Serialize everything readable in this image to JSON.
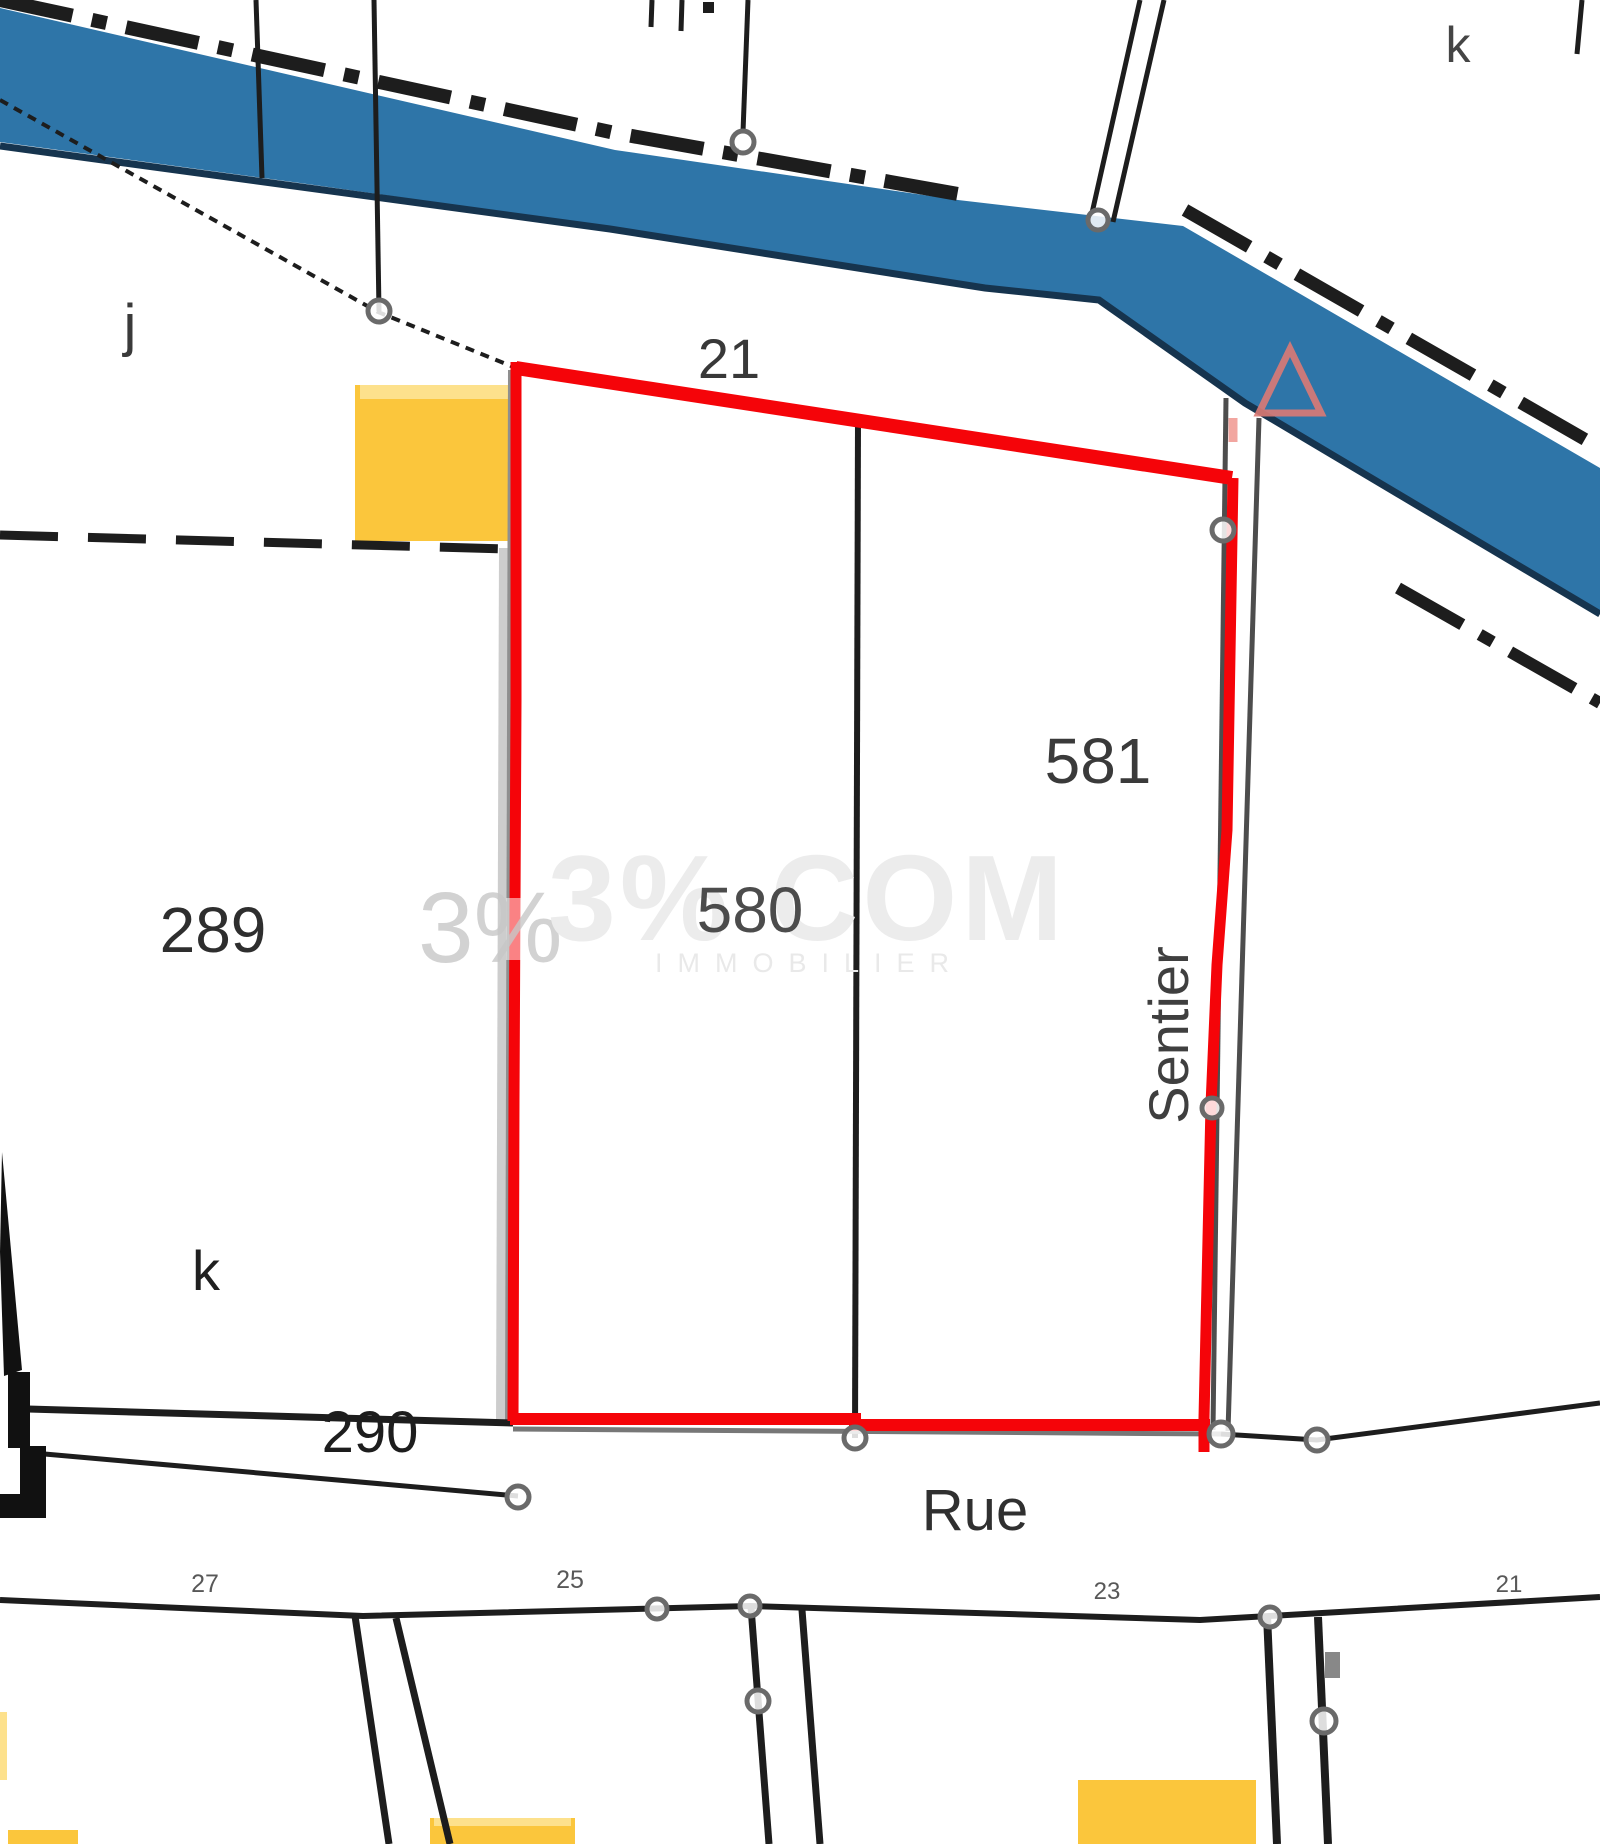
{
  "labels": {
    "parcels": {
      "p21": "21",
      "p289": "289",
      "p580": "580",
      "p581": "581",
      "p290": "290"
    },
    "sections": {
      "j": "j",
      "k_top": "k",
      "k_bottom": "k"
    },
    "streets": {
      "rue": "Rue",
      "sentier": "Sentier"
    },
    "house_numbers": {
      "h27": "27",
      "h25": "25",
      "h23": "23",
      "h21": "21"
    }
  },
  "watermark": {
    "logo": "3%",
    "name": "3% COM",
    "tagline": "IMMOBILIER"
  },
  "colors": {
    "selection_red": "#F50409",
    "river_blue": "#2E75A8",
    "river_bank_dark": "#16344E",
    "building_yellow": "#FBC63C",
    "building_yellow_light": "#FDE18C",
    "parcel_line_dark": "#1D1D1D",
    "node_circle_gray": "#6A6A6A",
    "path_gray": "#CDCDCD",
    "triangle_salmon": "#DC7A74",
    "watermark_gray": "#ECECEC"
  }
}
